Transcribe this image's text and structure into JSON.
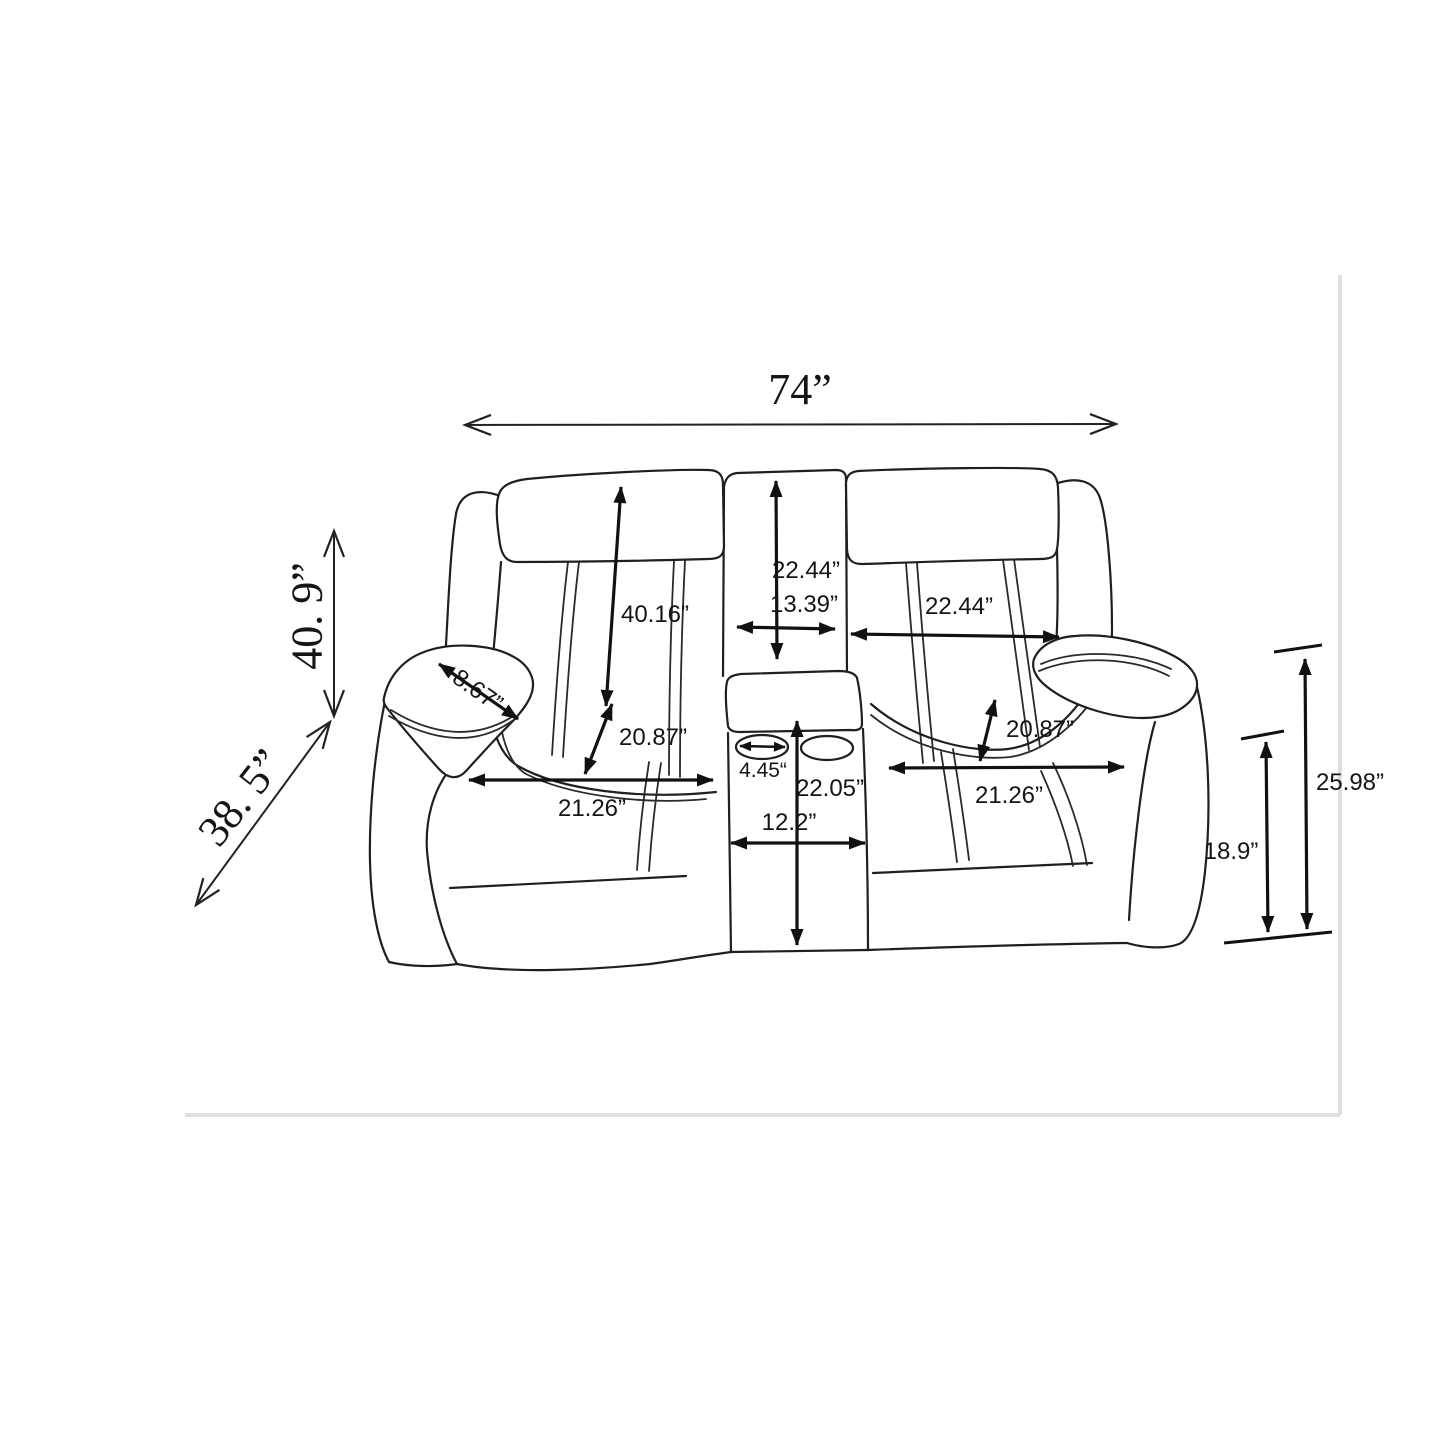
{
  "diagram": {
    "subject": "loveseat-with-console-dimension-drawing",
    "dimensions": {
      "overall_width": "74”",
      "overall_height": "40. 9”",
      "overall_depth": "38. 5”",
      "back_height": "40.16”",
      "console_back_height": "22.44”",
      "console_back_width": "13.39”",
      "right_back_width": "22.44”",
      "armrest_top_width": "8.67”",
      "left_seat_depth": "20.87”",
      "left_seat_width": "21.26”",
      "cup_holder_width": "4.45“",
      "console_height": "22.05”",
      "console_width": "12.2”",
      "right_seat_depth": "20.87”",
      "right_seat_width": "21.26”",
      "seat_height": "18.9”",
      "arm_height": "25.98”"
    },
    "colors": {
      "background": "#ffffff",
      "line": "#1f1f1f",
      "arrow": "#111111",
      "page_border": "#e0e0e0"
    }
  }
}
